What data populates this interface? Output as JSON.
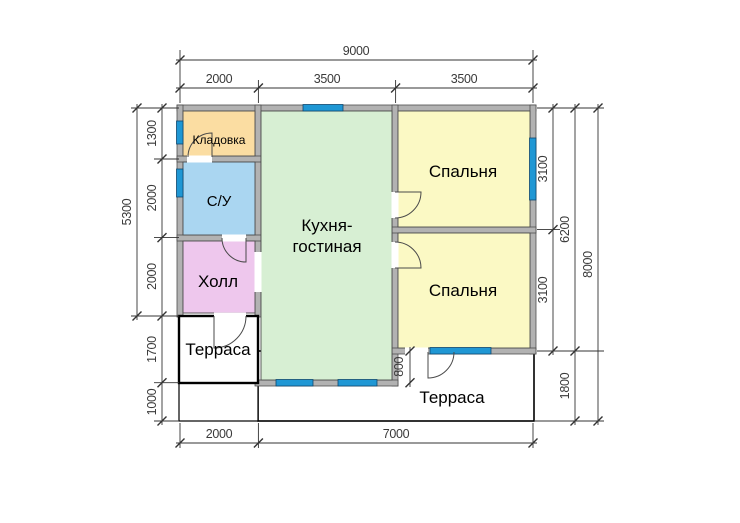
{
  "plan": {
    "rooms": {
      "storage": {
        "label": "Кладовка"
      },
      "bathroom": {
        "label": "С/У"
      },
      "hall": {
        "label": "Холл"
      },
      "kitchen_living": {
        "line1": "Кухня-",
        "line2": "гостиная"
      },
      "bedroom1": {
        "label": "Спальня"
      },
      "bedroom2": {
        "label": "Спальня"
      },
      "terrace_left": {
        "label": "Терраса"
      },
      "terrace_bottom": {
        "label": "Терраса"
      }
    },
    "dims": {
      "top_overall": "9000",
      "top_segments": [
        "2000",
        "3500",
        "3500"
      ],
      "left_overall": "5300",
      "left_segments": [
        "1300",
        "2000",
        "2000",
        "1700",
        "1000"
      ],
      "right_inner": [
        "3100",
        "3100"
      ],
      "right_mid": [
        "6200",
        "1800"
      ],
      "right_overall": "8000",
      "bottom_segments": [
        "2000",
        "7000"
      ],
      "terrace_depth": "800"
    },
    "colors": {
      "storage": "#fbdda2",
      "bathroom": "#aad6f1",
      "hall": "#eec7ed",
      "kitchen": "#d7efd3",
      "bedroom": "#fbf9c4",
      "wall": "#b2b2b2",
      "window": "#1f97d4"
    }
  }
}
